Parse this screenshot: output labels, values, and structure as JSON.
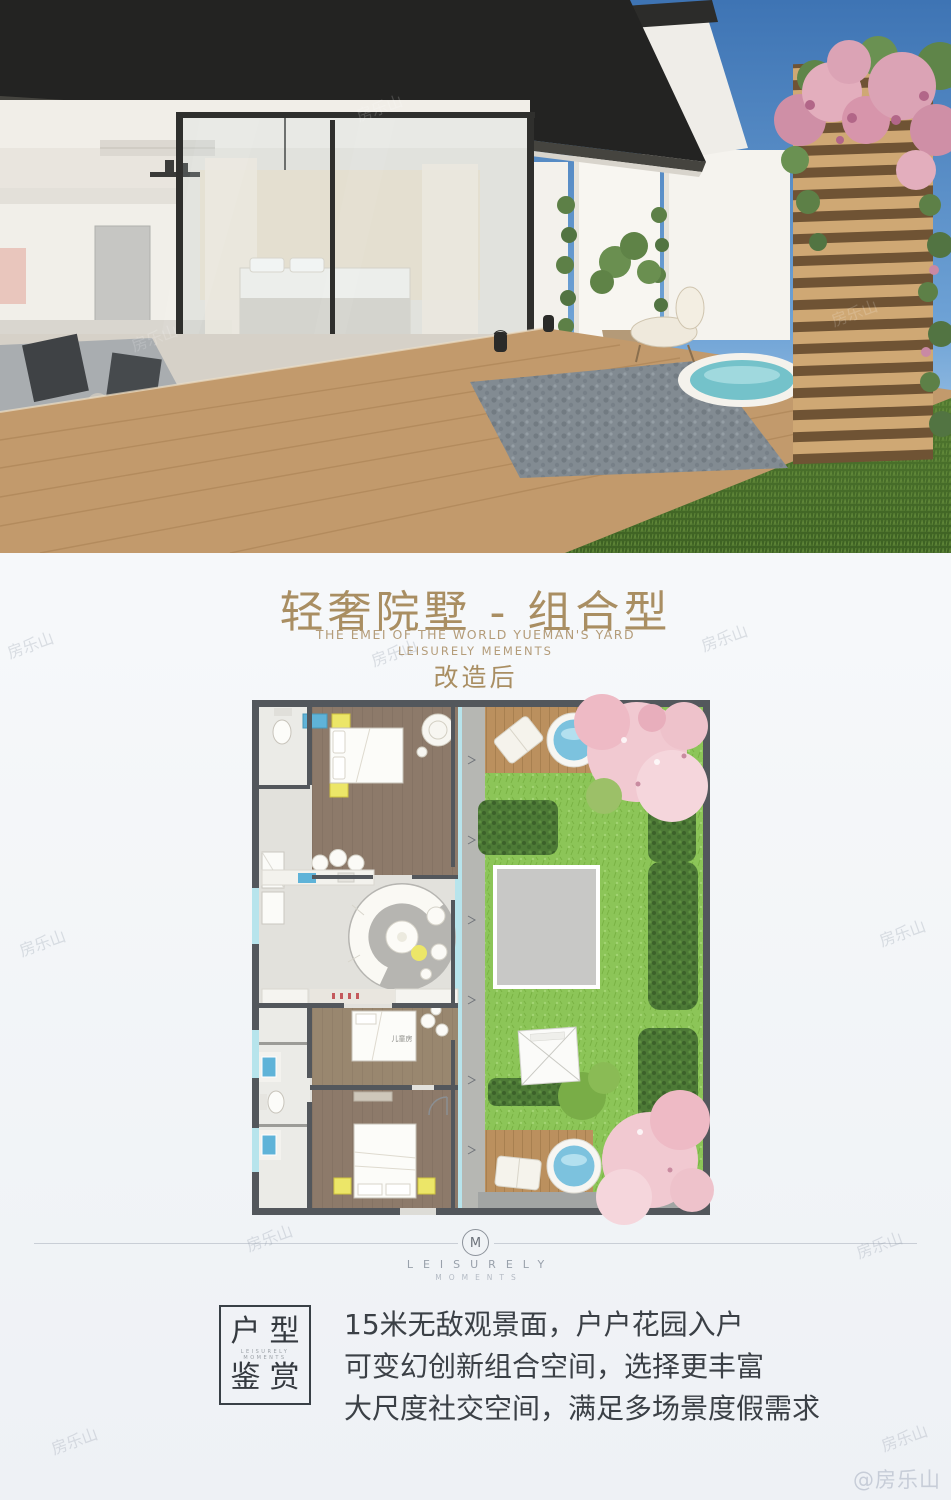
{
  "header": {
    "title": "轻奢院墅 - 组合型",
    "subtitle_en_1": "THE EMEI OF THE WORLD YUEMAN'S YARD",
    "subtitle_en_2": "LEISURELY MEMENTS",
    "phase_label": "改造后"
  },
  "floor_plan": {
    "labels": {
      "kids_room": "儿童房"
    }
  },
  "brand": {
    "monogram": "M",
    "name_line1": "LEISURELY",
    "name_line2": "MOMENTS"
  },
  "feature": {
    "box_title_top": "户型",
    "box_title_bottom": "鉴赏",
    "box_caption_1": "LEISURELY",
    "box_caption_2": "MOMENTS",
    "lines": [
      "15米无敌观景面，户户花园入户",
      "可变幻创新组合空间，选择更丰富",
      "大尺度社交空间，满足多场景度假需求"
    ]
  },
  "watermark": {
    "handle": "@房乐山",
    "tile": "房乐山"
  },
  "colors": {
    "accent_gold": "#a98e62",
    "text_dark": "#3b4046",
    "lawn_green": "#8cc558",
    "hedge_green": "#4d7a36",
    "deck_wood": "#bb905e",
    "water_blue": "#7cc2de",
    "blossom_pink": "#f1c9d1",
    "wall_gray": "#53575c",
    "sky_blue": "#3e74b4"
  }
}
